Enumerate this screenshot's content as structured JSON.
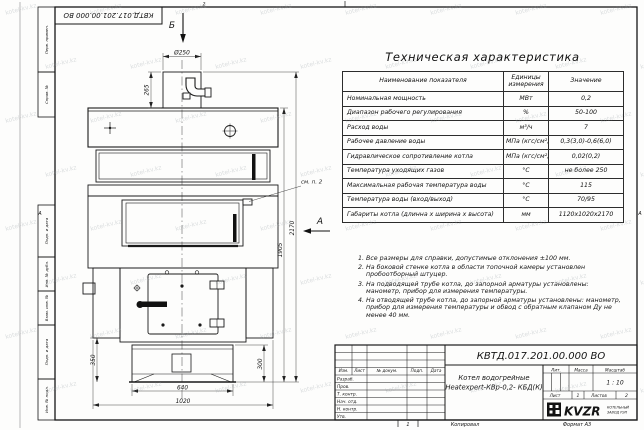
{
  "page": {
    "watermark": "kotel-kv.kz",
    "zone_top": "2",
    "zone_bottom": "1",
    "zone_letter": "А"
  },
  "frame": {
    "top_stamp": "КВТД.017.201.00.000 ВО",
    "margin_labels": [
      "Перв. примен.",
      "Справ. №",
      "Подп. и дата",
      "Инв. № дубл.",
      "Взам. инв. №",
      "Подп. и дата",
      "Инв. № подл."
    ]
  },
  "drawing": {
    "view_b": "Б",
    "view_a": "А",
    "callout_note2": "см. п. 2",
    "dims": {
      "d250": "Ø250",
      "h265": "265",
      "h2170": "2170",
      "h1905": "1905",
      "h350": "350",
      "h300": "300",
      "w640": "640",
      "w1020": "1020"
    }
  },
  "spec_table": {
    "title": "Техническая характеристика",
    "headers": [
      "Наименование показателя",
      "Единицы измерения",
      "Значение"
    ],
    "rows": [
      [
        "Номинальная мощность",
        "МВт",
        "0,2"
      ],
      [
        "Диапазон рабочего регулирования",
        "%",
        "50-100"
      ],
      [
        "Расход воды",
        "м³/ч",
        "7"
      ],
      [
        "Рабочее давление воды",
        "МПа (кгс/см²)",
        "0,3(3,0)-0,6(6,0)"
      ],
      [
        "Гидравлическое сопротивление котла",
        "МПа (кгс/см²)",
        "0,02(0,2)"
      ],
      [
        "Температура уходящих газов",
        "°С",
        "не более 250"
      ],
      [
        "Максимальная рабочая температура воды",
        "°С",
        "115"
      ],
      [
        "Температура воды (вход/выход)",
        "°С",
        "70/95"
      ],
      [
        "Габариты котла (длинна х ширина х высота)",
        "мм",
        "1120х1020х2170"
      ]
    ]
  },
  "notes": {
    "items": [
      "Все размеры для справки, допустимые отклонения ±100 мм.",
      "На боковой стенке котла в области топочной камеры установлен пробоотборный штуцер.",
      "На подводящей трубе котла, до запорной арматуры установлены: манометр, прибор для измерения температуры.",
      "На отводящей трубе котла, до запорной арматуры установлены: манометр, прибор для измерения температуры и обвод с обратным клапаном Ду не менее 40 мм."
    ]
  },
  "title_block": {
    "doc_number": "КВТД.017.201.00.000 ВО",
    "product_name_line1": "Котел водогрейные",
    "product_name_line2": "Heatexpert-КВр-0,2- КБД(К)",
    "header_cols": [
      "Изм.",
      "Лист",
      "№ докум.",
      "Подп.",
      "Дата"
    ],
    "staff_rows": [
      "Разраб.",
      "Пров.",
      "Т. контр.",
      "Нач. отд.",
      "Н. контр.",
      "Утв."
    ],
    "lit_label": "Лит.",
    "mass_label": "Масса",
    "scale_label": "Масштаб",
    "scale_value": "1 : 10",
    "sheet_label": "Лист",
    "sheet_value": "1",
    "sheets_label": "Листов",
    "sheets_value": "2",
    "logo_text": "KVZR",
    "logo_caption_line1": "КОТЕЛЬНЫЙ",
    "logo_caption_line2": "ЗАВОД РЭП",
    "copied_label": "Копировал",
    "format_label": "Формат А3"
  }
}
